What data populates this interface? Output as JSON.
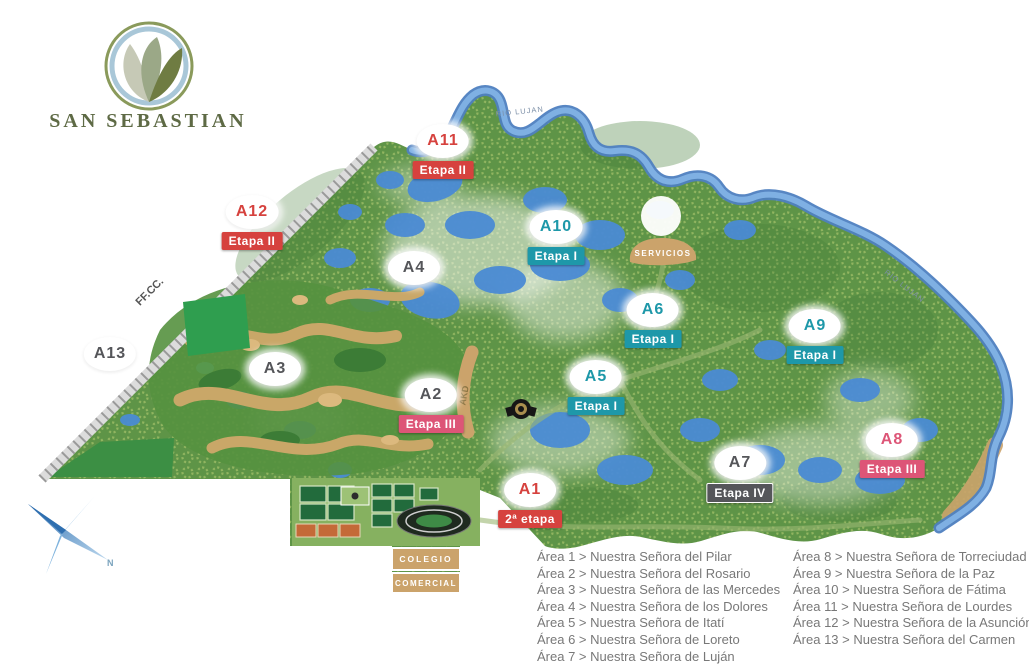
{
  "brand": {
    "name": "SAN SEBASTIAN",
    "logo_icon": "leaves-in-circle"
  },
  "colors": {
    "etapa_red": "#d6423e",
    "etapa_teal": "#1e98a9",
    "etapa_pink": "#dd5577",
    "etapa_dark": "#55565a",
    "marker_bg": "#ffffff",
    "brand_olive": "#5e6a45",
    "legend_text": "#787878",
    "land": "#5e9447",
    "water": "#4a8bd4",
    "sand": "#cba36b"
  },
  "map_labels": {
    "railroad": "FF.CC.",
    "river": "RIO LUJAN",
    "services": "SERVICIOS",
    "school": "COLEGIO",
    "commercial": "COMERCIAL",
    "road": "AKD",
    "compass_north": "N"
  },
  "markers": [
    {
      "label": "A11",
      "etapa": "Etapa II"
    },
    {
      "label": "A12",
      "etapa": "Etapa II"
    },
    {
      "label": "A13",
      "etapa": null
    },
    {
      "label": "A10",
      "etapa": "Etapa I"
    },
    {
      "label": "A4",
      "etapa": null
    },
    {
      "label": "A3",
      "etapa": null
    },
    {
      "label": "A6",
      "etapa": "Etapa I"
    },
    {
      "label": "A5",
      "etapa": "Etapa I"
    },
    {
      "label": "A9",
      "etapa": "Etapa I"
    },
    {
      "label": "A2",
      "etapa": "Etapa III"
    },
    {
      "label": "A8",
      "etapa": "Etapa III"
    },
    {
      "label": "A7",
      "etapa": "Etapa IV"
    },
    {
      "label": "A1",
      "etapa": "2ª etapa"
    }
  ],
  "legend": {
    "left": [
      "Área 1 > Nuestra Señora del Pilar",
      "Área 2 > Nuestra Señora del Rosario",
      "Área 3 > Nuestra Señora de las Mercedes",
      "Área 4 > Nuestra Señora de los Dolores",
      "Área 5 > Nuestra Señora de Itatí",
      "Área 6 > Nuestra Señora de Loreto",
      "Área 7 > Nuestra Señora de Luján"
    ],
    "right": [
      "Área 8 > Nuestra Señora de Torreciudad",
      "Área 9 > Nuestra Señora de la Paz",
      "Área 10 > Nuestra Señora de Fátima",
      "Área 11 > Nuestra Señora de Lourdes",
      "Área 12 > Nuestra Señora de la Asunción",
      "Área 13 > Nuestra Señora del Carmen"
    ]
  }
}
